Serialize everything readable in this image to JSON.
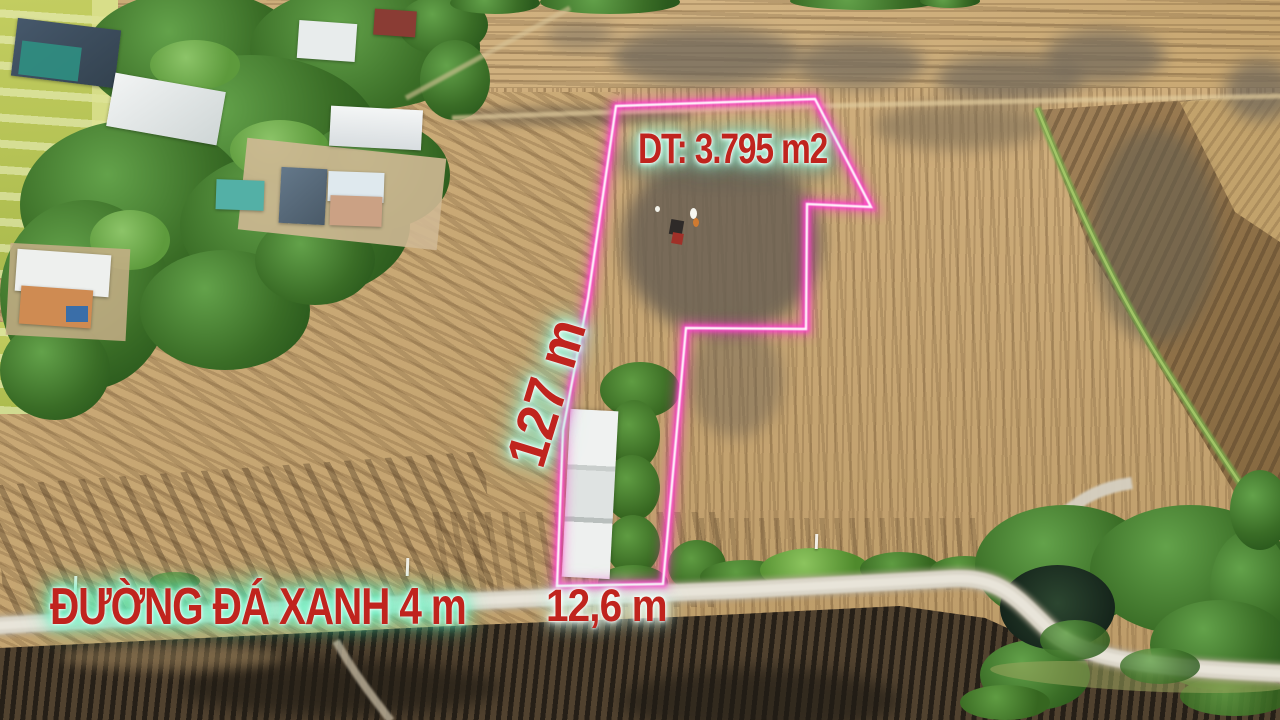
{
  "photo": {
    "labels": {
      "area": "DT: 3.795 m2",
      "depth": "127 m",
      "frontage": "12,6 m",
      "road_name": "ĐƯỜNG ĐÁ XANH 4 m"
    },
    "colors": {
      "boundary_pink": "#ff3ec9",
      "boundary_inner_white": "#ffffff",
      "label_red": "#c0241e",
      "label_glow_mint": "#8cf2d4",
      "road_label_glow_green": "#4deeb6",
      "road_surface": "#dad5c8",
      "field_tan": "#c9a974",
      "burnt_field_dark": "#43382a",
      "tree_green": "#3a6d26"
    }
  }
}
